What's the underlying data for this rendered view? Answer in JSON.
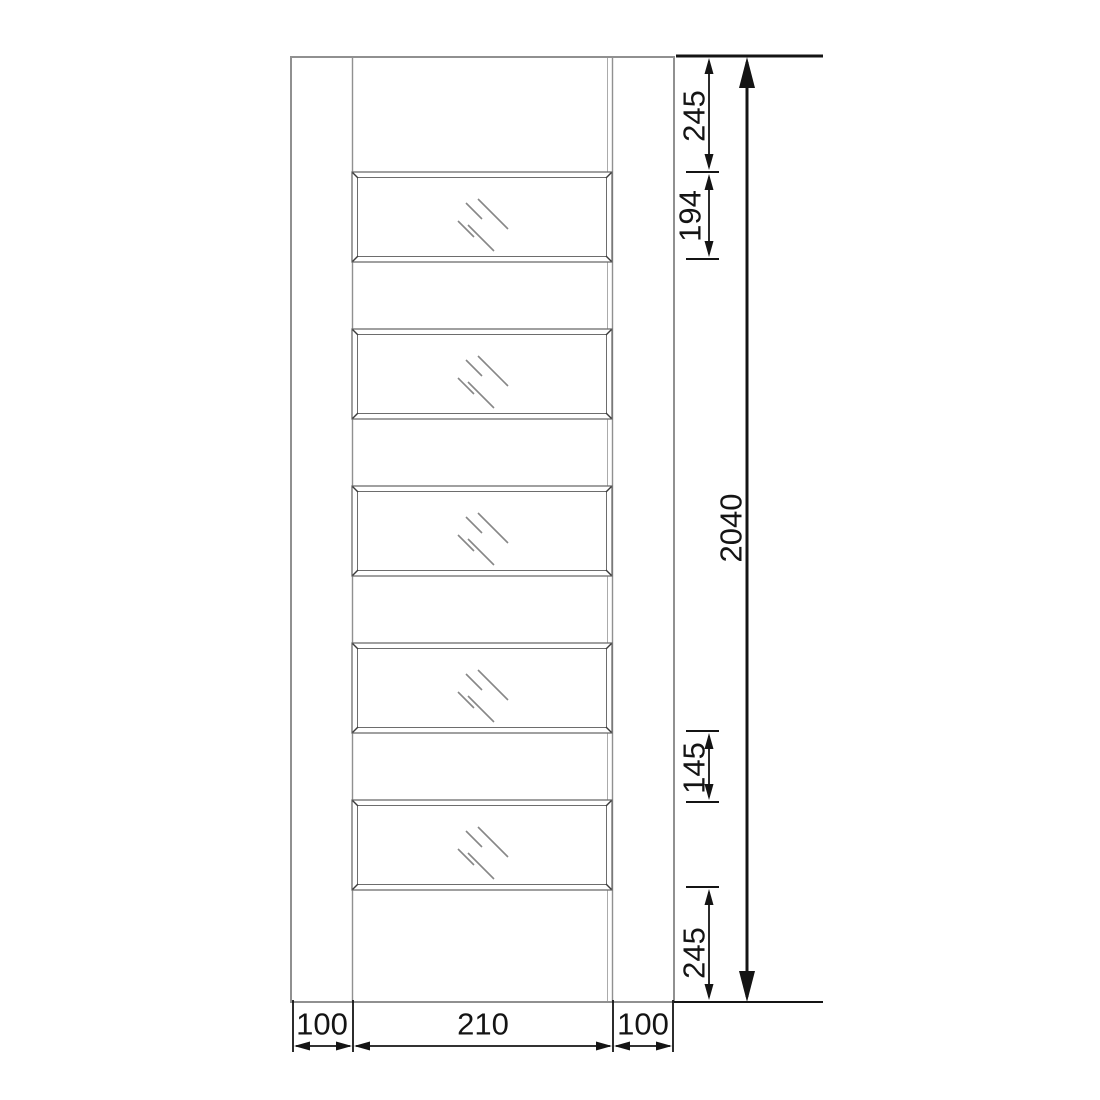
{
  "drawing": {
    "subject": "glazed-door-elevation",
    "panel_count": "5",
    "colors": {
      "door_stroke": "#909090",
      "panel_stroke": "#6d6d6d",
      "glass_stroke": "#878787",
      "dimension": "#141414",
      "background": "#ffffff"
    },
    "dimensions": {
      "right": {
        "top_rail": "245",
        "panel_height": "194",
        "door_height": "2040",
        "mid_rail": "145",
        "bottom_rail": "245"
      },
      "bottom": {
        "left_stile": "100",
        "glass_width": "210",
        "right_stile": "100"
      }
    }
  }
}
